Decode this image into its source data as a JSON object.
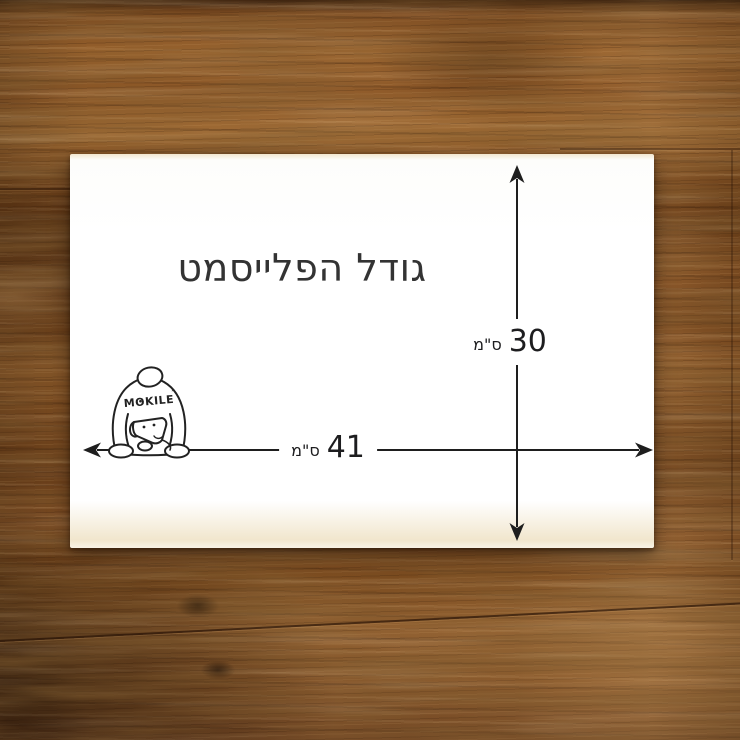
{
  "placemat": {
    "title": "גודל הפלייסמט",
    "height_value": "30",
    "height_unit": "ס\"מ",
    "width_value": "41",
    "width_unit": "ס\"מ",
    "brand": "MOKILE",
    "brand_mark": "’"
  },
  "colors": {
    "card": "#ffffff",
    "ink": "#1e1e1e",
    "title_ink": "#333333",
    "wood_base": "#82512a",
    "wood_dark": "#4a2a10",
    "wood_light": "#a97a45"
  }
}
